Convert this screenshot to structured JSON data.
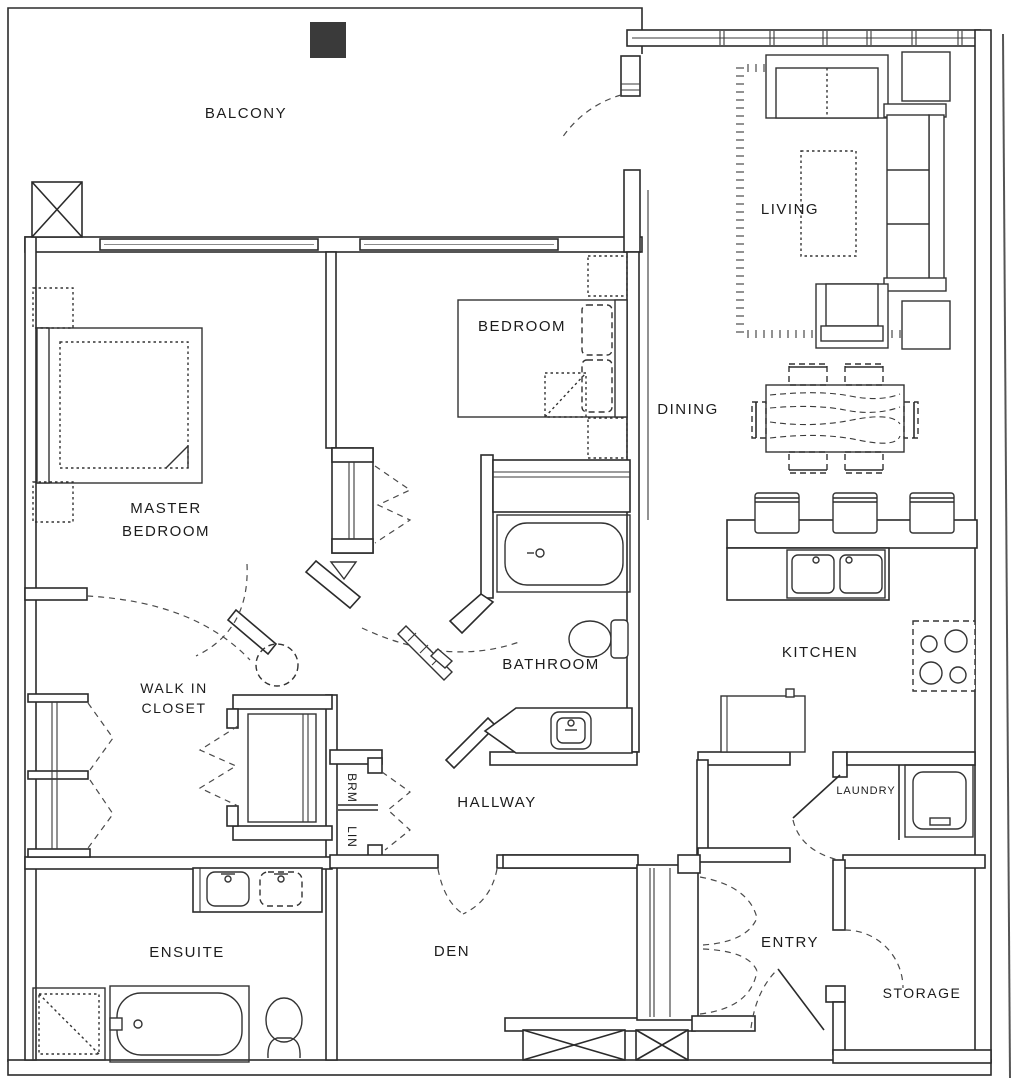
{
  "title": "Apartment Floor Plan",
  "colors": {
    "line": "#2b2b2b",
    "paper": "#ffffff",
    "dark_square": "#3a3a3a"
  },
  "rooms": {
    "balcony": "BALCONY",
    "living": "LIVING",
    "master_line1": "MASTER",
    "master_line2": "BEDROOM",
    "bedroom": "BEDROOM",
    "dining": "DINING",
    "kitchen": "KITCHEN",
    "bathroom": "BATHROOM",
    "walkin_line1": "WALK IN",
    "walkin_line2": "CLOSET",
    "hallway": "HALLWAY",
    "brm": "BRM",
    "lin": "LIN",
    "laundry": "LAUNDRY",
    "ensuite": "ENSUITE",
    "den": "DEN",
    "entry": "ENTRY",
    "storage": "STORAGE"
  }
}
